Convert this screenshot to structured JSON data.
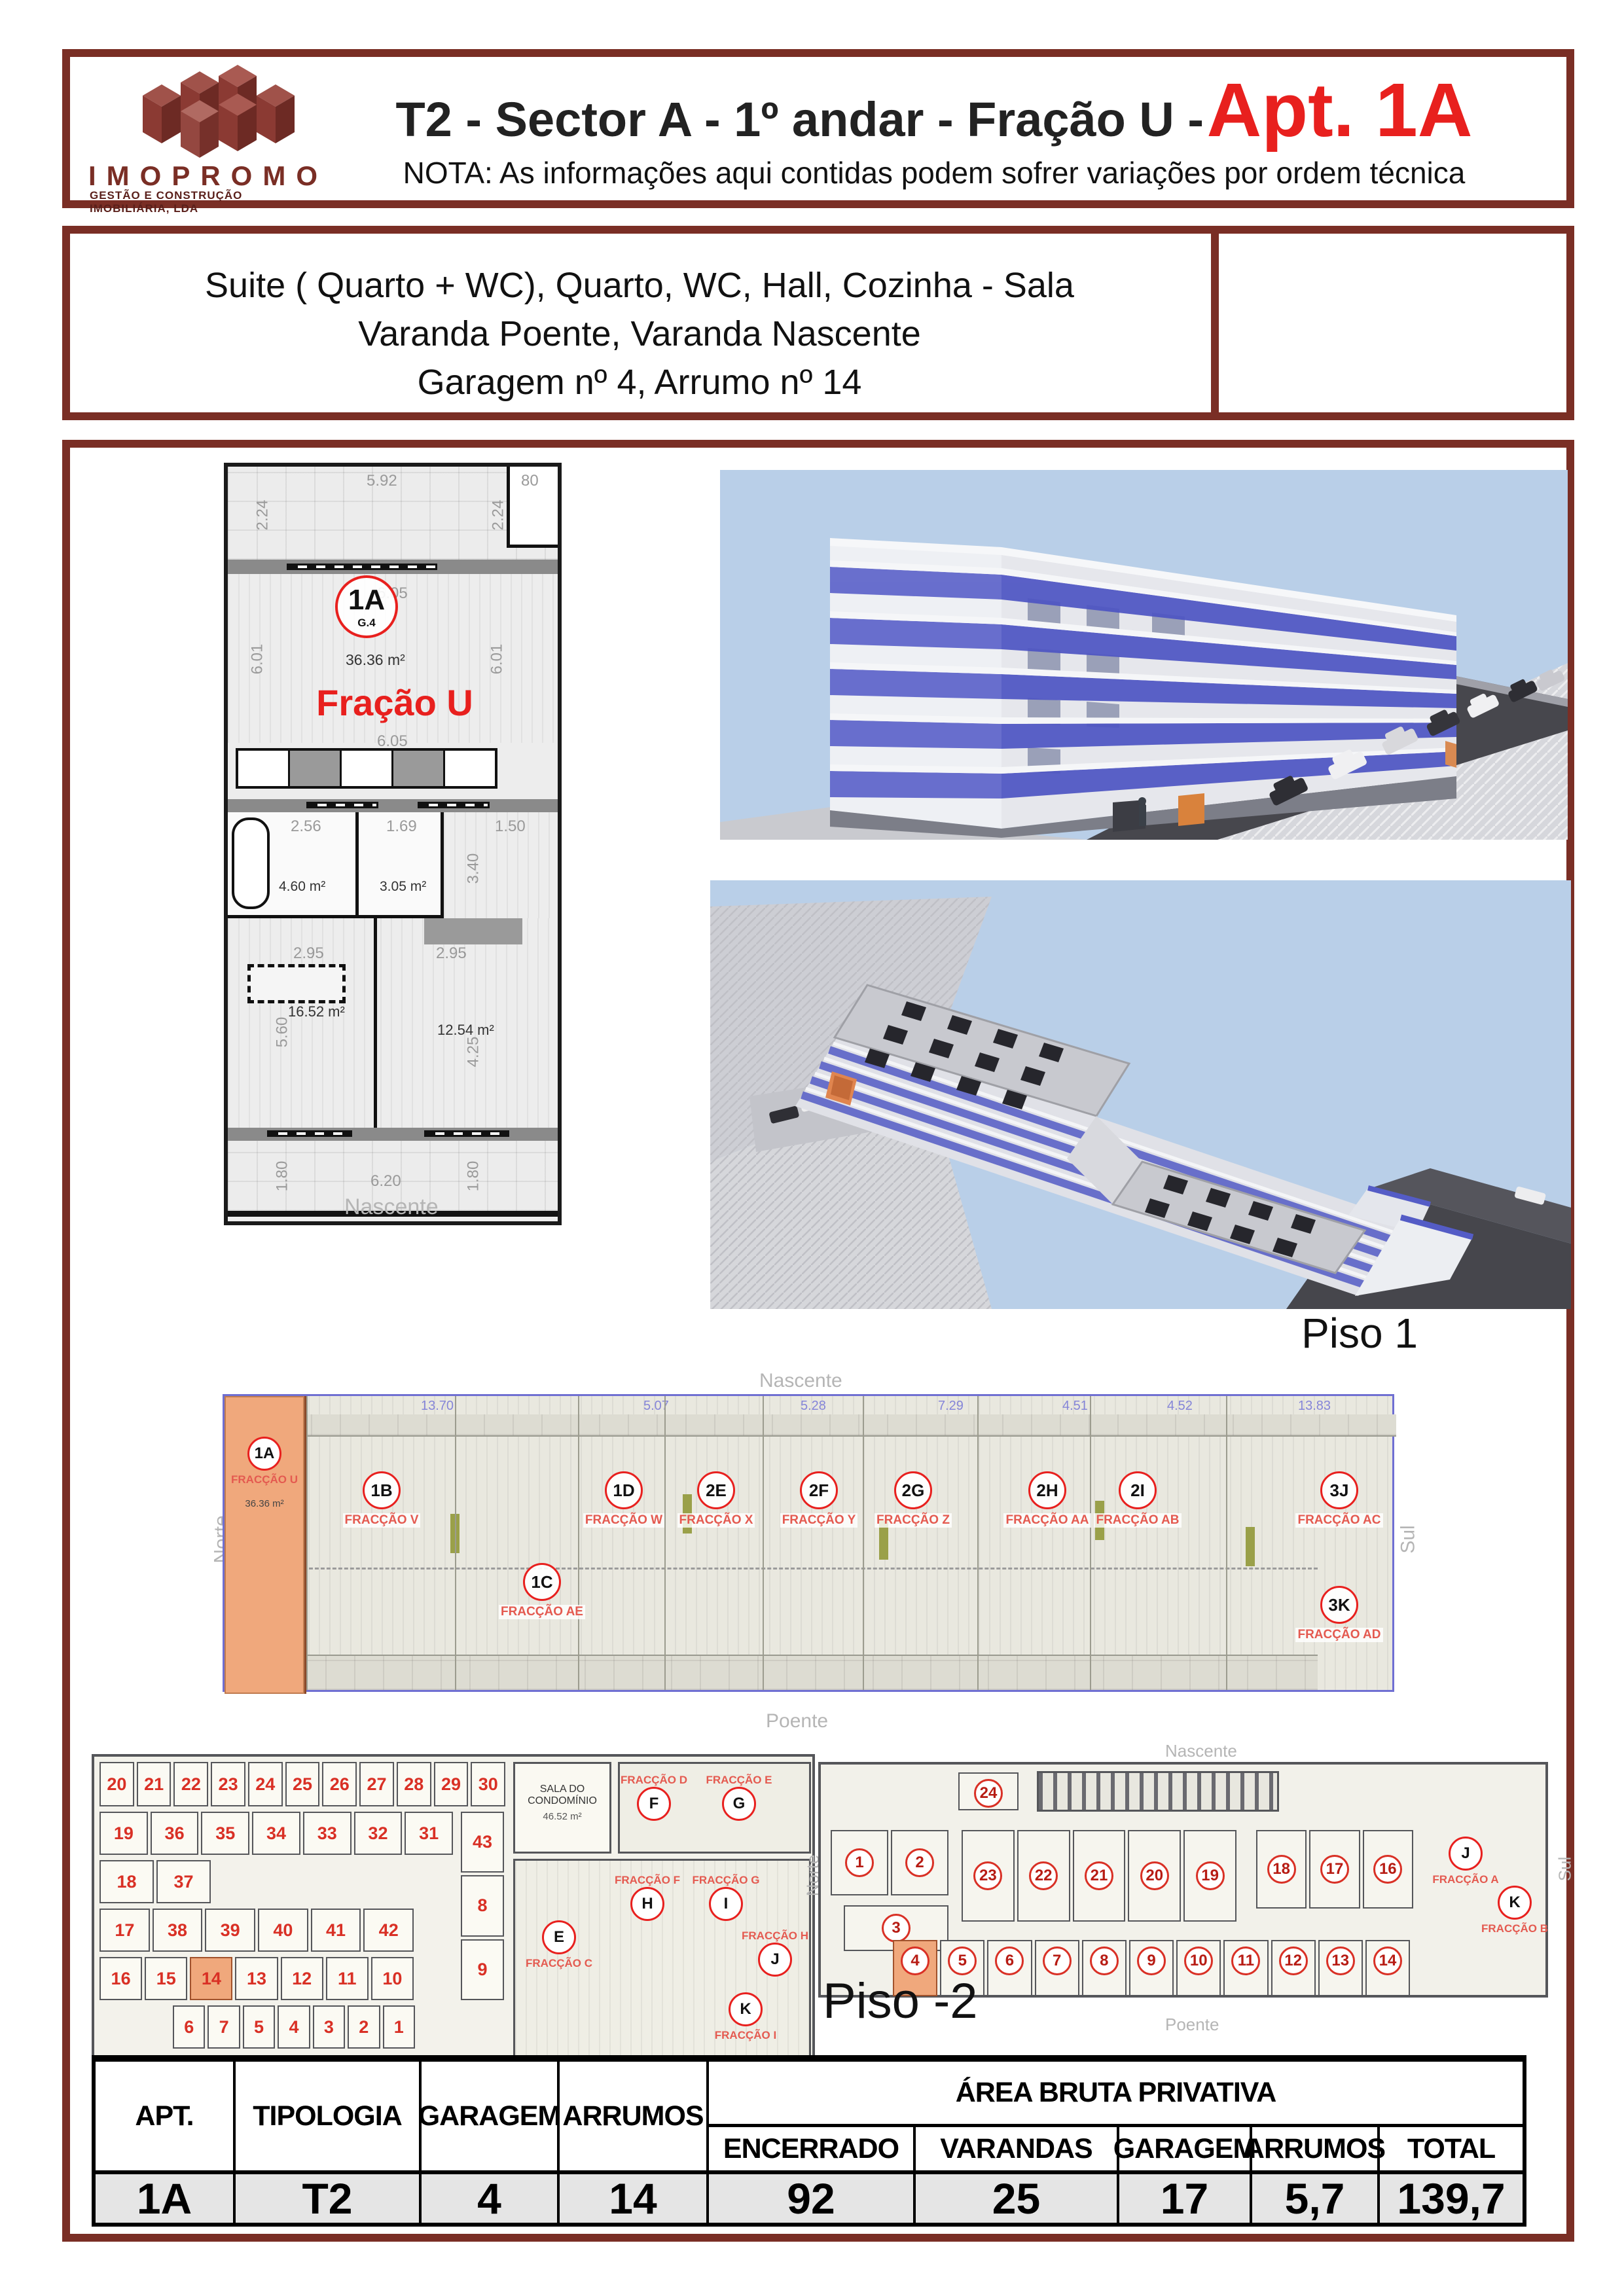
{
  "colors": {
    "border_maroon": "#7a2e25",
    "accent_red": "#e8201e",
    "highlight_orange": "#f0a87c",
    "sky_blue": "#b9cfe8",
    "building_blue": "#4e55c3",
    "table_row_bg": "#e5e5e5"
  },
  "header": {
    "logo_name": "IMOPROMO",
    "logo_subtitle": "GESTÃO E CONSTRUÇÃO IMOBILIÁRIA, LDA",
    "title_black": "T2 - Sector A - 1º andar - Fração U -",
    "title_red": "Apt. 1A",
    "note": "NOTA: As informações aqui contidas podem sofrer variações por ordem técnica"
  },
  "description": {
    "line1": "Suite ( Quarto + WC), Quarto, WC, Hall, Cozinha - Sala",
    "line2": "Varanda Poente, Varanda Nascente",
    "line3": "Garagem nº 4, Arrumo nº 14"
  },
  "apartment_plan": {
    "unit_id": "1A",
    "unit_sub": "G.4",
    "living_area": "36.36 m²",
    "fraction_name": "Fração U",
    "compass_bottom": "Nascente",
    "rooms": {
      "bath1": "4.60 m²",
      "bath2": "3.05 m²",
      "hall": "6.84 m²",
      "bed1": "16.52 m²",
      "bed2": "12.54 m²"
    },
    "dims": {
      "terrace_w": "5.92",
      "terrace_right": "80",
      "terrace_side": "2.24",
      "terrace_side2": "2.24",
      "living_w": "6.05",
      "living_w2": "6.05",
      "living_h": "6.01",
      "living_h2": "6.01",
      "bath1_w": "2.56",
      "bath2_w": "1.69",
      "hall_w": "1.50",
      "hall_h": "3.40",
      "bed_w": "2.95",
      "bed_w2": "2.95",
      "bed1_h": "5.60",
      "bed2_h": "4.25",
      "balcony_h": "1.80",
      "balcony_h2": "1.80",
      "balcony_w": "6.20"
    }
  },
  "piso1": {
    "title": "Piso 1",
    "compass": {
      "top": "Nascente",
      "bottom": "Poente",
      "left": "Norte",
      "right": "Sul"
    },
    "highlight_unit": {
      "id": "1A",
      "sub": "G.4",
      "fraction": "FRACÇÃO U",
      "area": "36.36 m²"
    },
    "dims_top": {
      "d1": "5.92",
      "d2": "13.70",
      "d3": "5.07",
      "d4": "5.28",
      "d5": "7.29",
      "d6": "4.51",
      "d7": "4.52",
      "d8": "13.83"
    },
    "units": [
      {
        "id": "1B",
        "fraction": "FRACÇÃO V"
      },
      {
        "id": "1C",
        "fraction": "FRACÇÃO AE"
      },
      {
        "id": "1D",
        "fraction": "FRACÇÃO W"
      },
      {
        "id": "2E",
        "fraction": "FRACÇÃO X"
      },
      {
        "id": "2F",
        "fraction": "FRACÇÃO Y"
      },
      {
        "id": "2G",
        "fraction": "FRACÇÃO Z"
      },
      {
        "id": "2H",
        "fraction": "FRACÇÃO AA"
      },
      {
        "id": "2I",
        "fraction": "FRACÇÃO AB"
      },
      {
        "id": "3J",
        "fraction": "FRACÇÃO AC"
      },
      {
        "id": "3K",
        "fraction": "FRACÇÃO AD"
      }
    ]
  },
  "arrumos_plan": {
    "sala_label": "SALA DO CONDOMÍNIO",
    "sala_area": "46.52 m²",
    "row1": [
      "20",
      "21",
      "22",
      "23",
      "24",
      "25",
      "26",
      "27",
      "28",
      "29",
      "30"
    ],
    "row2": [
      "19",
      "36",
      "35",
      "34",
      "33",
      "32",
      "31"
    ],
    "row3": [
      "18",
      "37"
    ],
    "row4": [
      "17",
      "38",
      "39",
      "40",
      "41",
      "42"
    ],
    "row5": [
      "16",
      "15",
      "14",
      "13",
      "12",
      "11",
      "10"
    ],
    "row6": [
      "6",
      "7",
      "5",
      "4",
      "3",
      "2",
      "1"
    ],
    "side": [
      "43",
      "8",
      "9"
    ],
    "highlight": "14",
    "fractions": [
      {
        "circle": "E",
        "label": "FRACÇÃO C"
      },
      {
        "circle": "F",
        "label": "FRACÇÃO D"
      },
      {
        "circle": "G",
        "label": "FRACÇÃO E"
      },
      {
        "circle": "H",
        "label": "FRACÇÃO F"
      },
      {
        "circle": "I",
        "label": "FRACÇÃO G"
      },
      {
        "circle": "J",
        "label": "FRACÇÃO H"
      },
      {
        "circle": "K",
        "label": "FRACÇÃO I"
      }
    ]
  },
  "garage_plan": {
    "label": "Piso -2",
    "compass": {
      "top": "Nascente",
      "bottom": "Poente",
      "left": "Norte",
      "right": "Sul"
    },
    "top_cell": "24",
    "mid_row_a": [
      "23",
      "22",
      "21",
      "20",
      "19"
    ],
    "mid_row_b": [
      "18",
      "17",
      "16"
    ],
    "left_cells": [
      "1",
      "2"
    ],
    "left_cell3": "3",
    "bottom_row": [
      "4",
      "5",
      "6",
      "7",
      "8",
      "9",
      "10",
      "11",
      "12",
      "13",
      "14"
    ],
    "highlight": "4",
    "fractions": [
      {
        "circle": "J",
        "label": "FRACÇÃO A"
      },
      {
        "circle": "K",
        "label": "FRACÇÃO B"
      }
    ]
  },
  "table": {
    "col_apt": "APT.",
    "col_tipologia": "TIPOLOGIA",
    "col_garagem": "GARAGEM",
    "col_arrumos": "ARRUMOS",
    "group_header": "ÁREA BRUTA PRIVATIVA",
    "sub_encerrado": "ENCERRADO",
    "sub_varandas": "VARANDAS",
    "sub_garagem": "GARAGEM",
    "sub_arrumos": "ARRUMOS",
    "sub_total": "TOTAL",
    "values": {
      "apt": "1A",
      "tipologia": "T2",
      "garagem": "4",
      "arrumos": "14",
      "encerrado": "92",
      "varandas": "25",
      "garagem_area": "17",
      "arrumos_area": "5,7",
      "total": "139,7"
    }
  }
}
